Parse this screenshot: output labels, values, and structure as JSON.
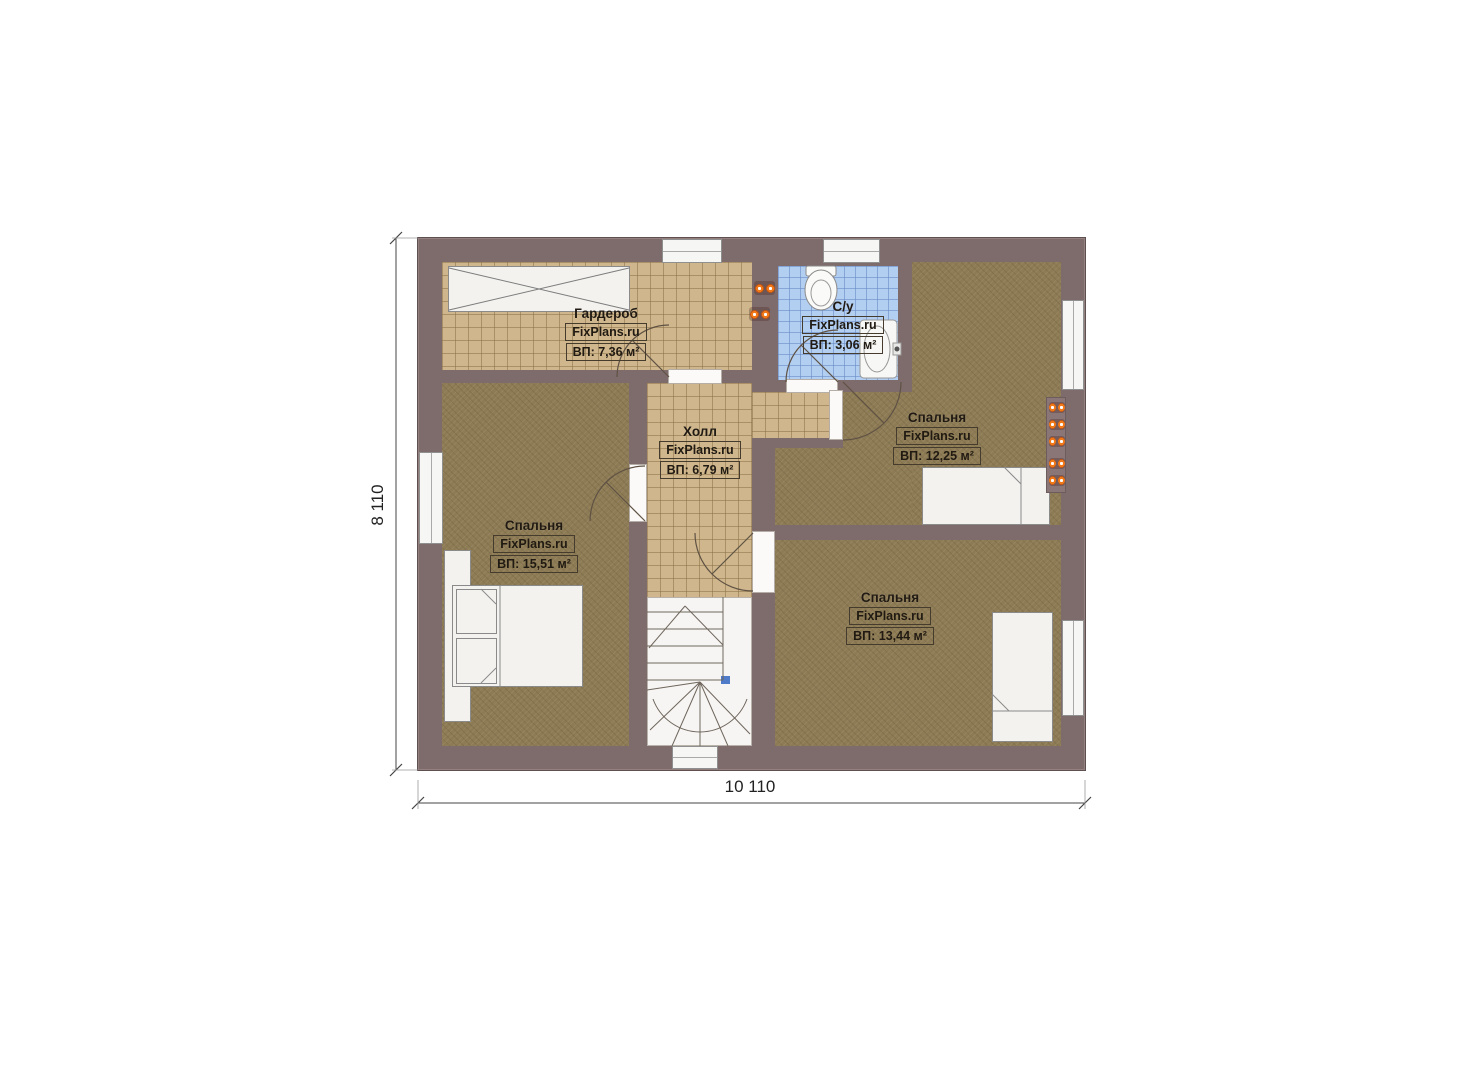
{
  "page": {
    "background_color": "#ffffff"
  },
  "plan": {
    "brand": "FixPlans.ru",
    "colors": {
      "wall": "#7e6b6c",
      "tile_floor": "#cfb68c",
      "carpet_floor": "#8d7b55",
      "bathroom_floor": "#b2cef1",
      "furniture": "#f3f2ef",
      "radiator_orange": "#f07818",
      "stair_marker_blue": "#4f7bc9"
    },
    "rooms": [
      {
        "id": "wardrobe",
        "name": "Гардероб",
        "brand": "FixPlans.ru",
        "area": "ВП: 7,36 м²"
      },
      {
        "id": "bathroom",
        "name": "С/у",
        "brand": "FixPlans.ru",
        "area": "ВП: 3,06 м²"
      },
      {
        "id": "bedroom-right",
        "name": "Спальня",
        "brand": "FixPlans.ru",
        "area": "ВП: 12,25 м²"
      },
      {
        "id": "hall",
        "name": "Холл",
        "brand": "FixPlans.ru",
        "area": "ВП: 6,79 м²"
      },
      {
        "id": "bedroom-left",
        "name": "Спальня",
        "brand": "FixPlans.ru",
        "area": "ВП: 15,51 м²"
      },
      {
        "id": "bedroom-bottom",
        "name": "Спальня",
        "brand": "FixPlans.ru",
        "area": "ВП: 13,44 м²"
      }
    ],
    "dimensions": {
      "width": "10 110",
      "height": "8 110"
    }
  }
}
